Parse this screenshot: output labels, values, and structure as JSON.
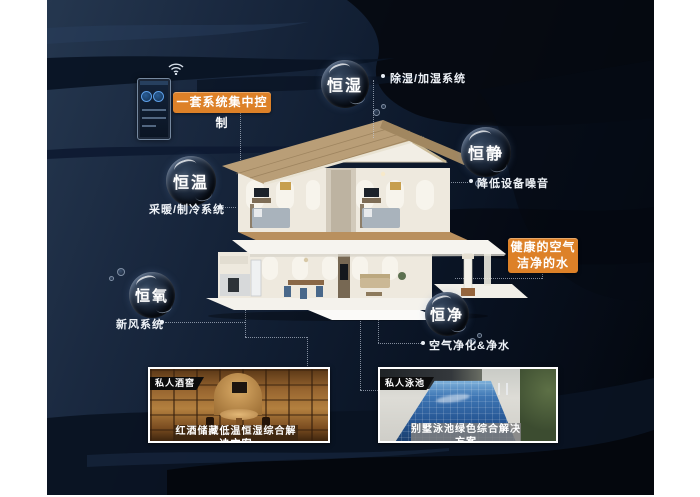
{
  "colors": {
    "accent_orange": "#DD8128",
    "background_navy": "#16253E",
    "label_text": "#EEF2F7"
  },
  "control": {
    "badge": "一套系统集中控制",
    "wifi_icon": "wifi-icon",
    "panel_icon": "smart-control-panel"
  },
  "bubbles": {
    "humidity": {
      "label": "恒湿",
      "note": "除湿/加湿系统"
    },
    "quiet": {
      "label": "恒静",
      "note": "降低设备噪音"
    },
    "temperature": {
      "label": "恒温",
      "note": "采暖/制冷系统"
    },
    "oxygen": {
      "label": "恒氧",
      "note": "新风系统"
    },
    "purity": {
      "label": "恒净",
      "note": "空气净化&净水"
    }
  },
  "highlight": {
    "line1": "健康的空气",
    "line2": "洁净的水"
  },
  "photos": {
    "wine": {
      "tag": "私人酒窖",
      "caption": "红酒储藏低温恒湿综合解决方案"
    },
    "pool": {
      "tag": "私人泳池",
      "caption": "别墅泳池绿色综合解决方案"
    }
  }
}
